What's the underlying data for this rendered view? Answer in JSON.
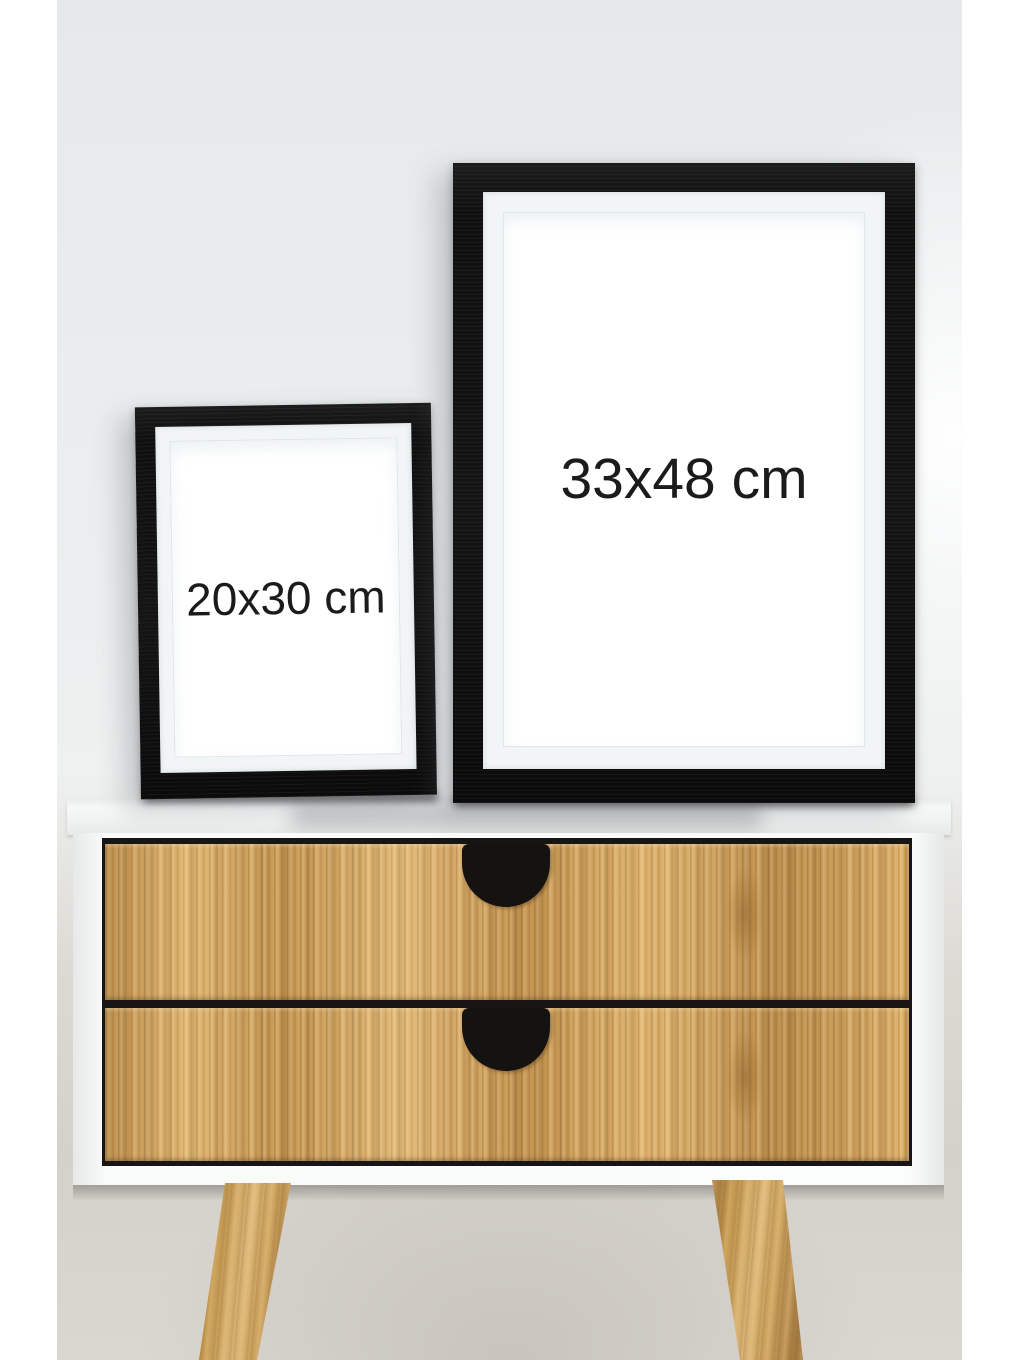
{
  "scene": {
    "type": "product-photo",
    "description": "Two black picture frames with white mats standing on a white sideboard with two oak drawers, black cut-out handles and splayed wooden legs against a light grey wall",
    "colors": {
      "canvas_border": "#ffffff",
      "wall_top": "#e9eced",
      "wall_bottom": "#d6d3cc",
      "frame_black": "#141414",
      "mat_white": "#f2f5f6",
      "poster_white": "#ffffff",
      "label_text": "#1b1b1b",
      "sideboard_white": "#fafbfb",
      "drawer_wood": "#d3a45b",
      "handle_black": "#141312",
      "leg_wood": "#c3984f"
    }
  },
  "frames": {
    "large": {
      "label": "33x48 cm"
    },
    "small": {
      "label": "20x30 cm"
    }
  },
  "sideboard": {
    "drawer_count": 2,
    "leg_count": 2
  }
}
